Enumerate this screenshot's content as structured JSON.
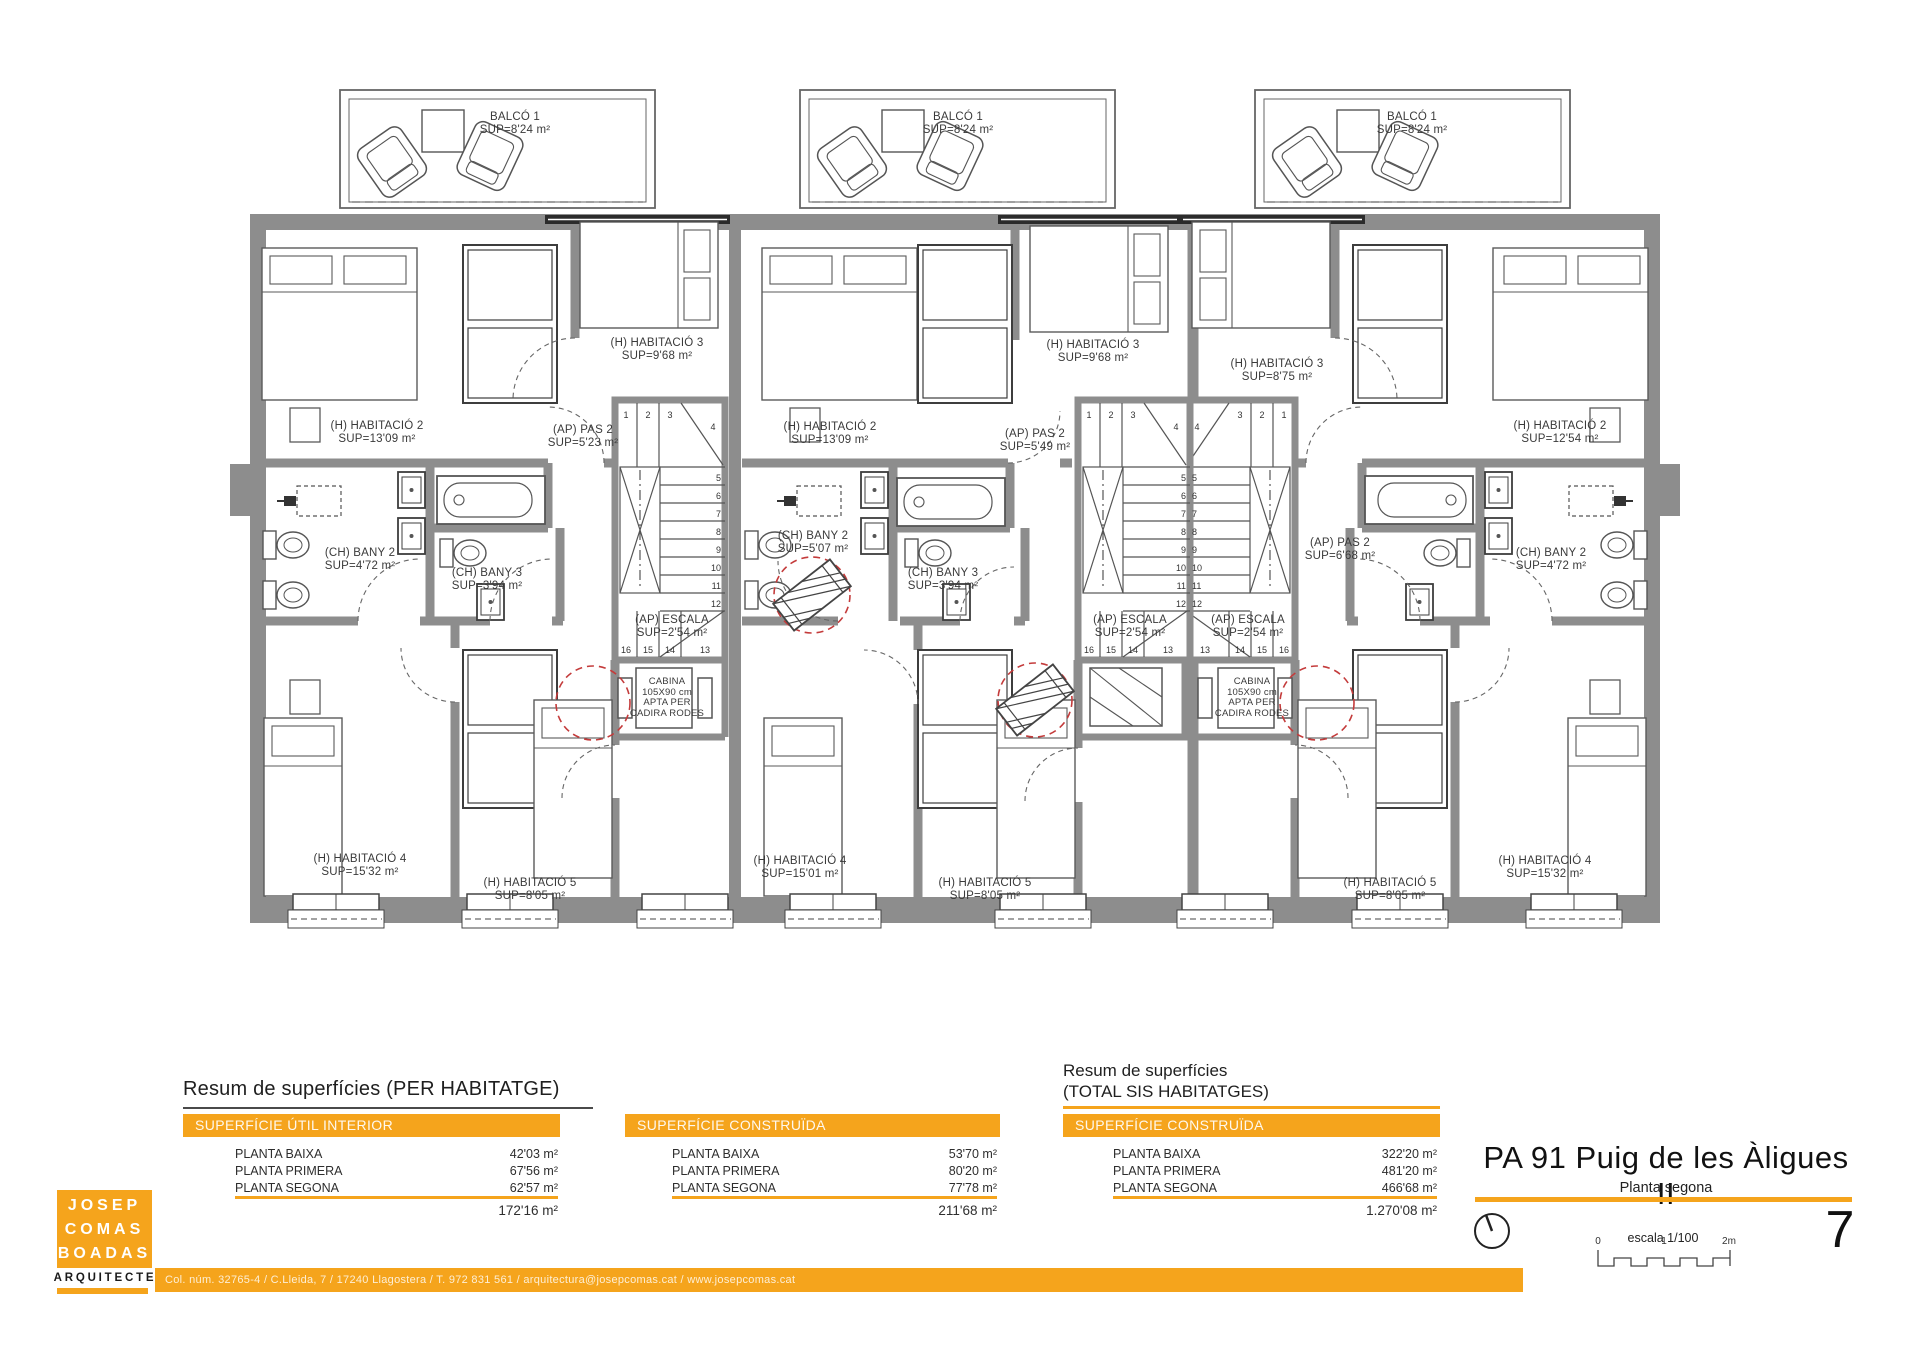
{
  "colors": {
    "accent": "#F5A41C",
    "wall": "#8d8d8d",
    "line": "#555555",
    "red": "#C43B3B"
  },
  "plan": {
    "balcony": {
      "label": "BALCÓ 1\nSUP=8'24 m²"
    },
    "cabina": "CABINA\n105X90 cm\nAPTA PER\nCADIRA RODES",
    "steps": [
      "1",
      "2",
      "3",
      "4",
      "5",
      "6",
      "7",
      "8",
      "9",
      "10",
      "11",
      "12",
      "13",
      "14",
      "15",
      "16"
    ],
    "units": [
      {
        "hab2": "(H) HABITACIÓ 2\nSUP=13'09 m²",
        "hab3": "(H) HABITACIÓ 3\nSUP=9'68 m²",
        "pas2": "(AP) PAS 2\nSUP=5'23 m²",
        "bany2": "(CH) BANY 2\nSUP=4'72 m²",
        "bany3": "(CH) BANY 3\nSUP=3'94 m²",
        "escala": "(AP) ESCALA\nSUP=2'54 m²",
        "hab4": "(H) HABITACIÓ 4\nSUP=15'32 m²",
        "hab5": "(H) HABITACIÓ 5\nSUP=8'05 m²"
      },
      {
        "hab2": "(H) HABITACIÓ 2\nSUP=13'09 m²",
        "hab3": "(H) HABITACIÓ 3\nSUP=9'68 m²",
        "pas2": "(AP) PAS 2\nSUP=5'49 m²",
        "bany2": "(CH) BANY 2\nSUP=5'07 m²",
        "bany3": "(CH) BANY 3\nSUP=3'94 m²",
        "escala": "(AP) ESCALA\nSUP=2'54 m²",
        "hab4": "(H) HABITACIÓ 4\nSUP=15'01 m²",
        "hab5": "(H) HABITACIÓ 5\nSUP=8'05 m²"
      },
      {
        "hab2": "(H) HABITACIÓ 2\nSUP=12'54 m²",
        "hab3": "(H) HABITACIÓ 3\nSUP=8'75 m²",
        "pas2": "(AP) PAS 2\nSUP=6'68 m²",
        "bany2": "(CH) BANY 2\nSUP=4'72 m²",
        "escala": "(AP) ESCALA\nSUP=2'54 m²",
        "hab4": "(H) HABITACIÓ 4\nSUP=15'32 m²",
        "hab5": "(H) HABITACIÓ 5\nSUP=8'05 m²"
      }
    ]
  },
  "summary": {
    "per_habitatge_title": "Resum de superfícies (PER HABITATGE)",
    "total_title_line1": "Resum de superfícies",
    "total_title_line2": "(TOTAL SIS HABITATGES)",
    "tables": [
      {
        "header": "SUPERFÍCIE ÚTIL INTERIOR",
        "rows": [
          {
            "label": "PLANTA BAIXA",
            "value": "42'03 m²"
          },
          {
            "label": "PLANTA PRIMERA",
            "value": "67'56 m²"
          },
          {
            "label": "PLANTA SEGONA",
            "value": "62'57 m²"
          }
        ],
        "total": "172'16 m²"
      },
      {
        "header": "SUPERFÍCIE CONSTRUÏDA",
        "rows": [
          {
            "label": "PLANTA BAIXA",
            "value": "53'70 m²"
          },
          {
            "label": "PLANTA PRIMERA",
            "value": "80'20 m²"
          },
          {
            "label": "PLANTA SEGONA",
            "value": "77'78 m²"
          }
        ],
        "total": "211'68 m²"
      },
      {
        "header": "SUPERFÍCIE CONSTRUÏDA",
        "rows": [
          {
            "label": "PLANTA BAIXA",
            "value": "322'20 m²"
          },
          {
            "label": "PLANTA PRIMERA",
            "value": "481'20 m²"
          },
          {
            "label": "PLANTA SEGONA",
            "value": "466'68 m²"
          }
        ],
        "total": "1.270'08 m²"
      }
    ]
  },
  "titleblock": {
    "title": "PA 91 Puig de les Àligues II",
    "subtitle": "Planta segona",
    "scale_label": "escala 1/100",
    "ticks": [
      "0",
      "1",
      "2m"
    ],
    "page": "7"
  },
  "logo": {
    "line1": "JOSEP",
    "line2": "COMAS",
    "line3": "BOADAS",
    "role": "ARQUITECTE"
  },
  "footer": {
    "credits": "Col. núm. 32765-4 / C.Lleida, 7 / 17240 Llagostera / T. 972 831 561 / arquitectura@josepcomas.cat / www.josepcomas.cat"
  }
}
